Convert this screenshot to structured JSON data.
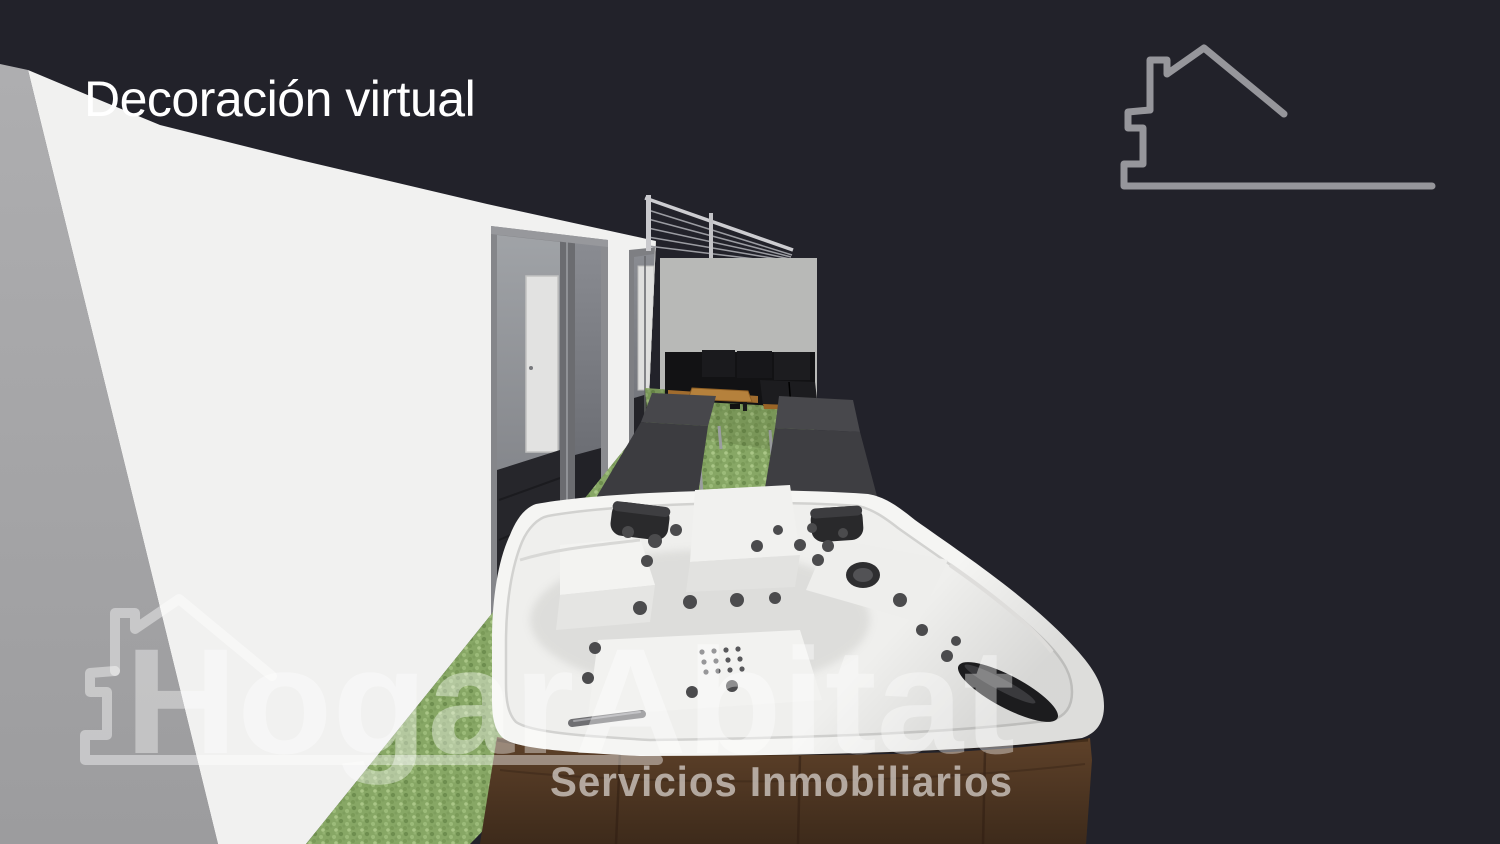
{
  "title": "Decoración virtual",
  "watermark": {
    "brand": "HogarAbitat",
    "tagline": "Servicios Inmobiliarios"
  },
  "logo": {
    "icon": "house-outline-icon"
  },
  "colors": {
    "background": "#22222a",
    "wall_white": "#f1f1f0",
    "wall_side": "#a9a9ab",
    "wall_far": "#b8b9b7",
    "grass": "#87a765",
    "wood": "#5e4129",
    "tub_shell": "#f5f5f3",
    "logo_gray": "#96969b",
    "title_text": "#ffffff"
  }
}
